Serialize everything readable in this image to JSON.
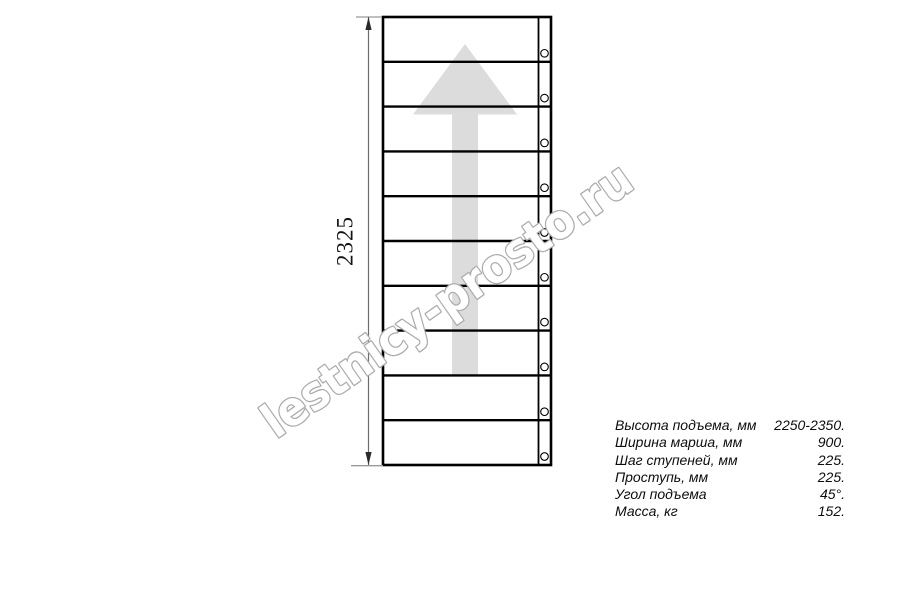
{
  "watermark": {
    "text": "lestnicy-prosto.ru",
    "fill": "#ffffff",
    "outline": "#acacac"
  },
  "drawing": {
    "dimension_label": "2325",
    "treads": 10,
    "arrow_direction": "up",
    "arrow_color": "#dcdcdc",
    "line_color": "#000000"
  },
  "specs": {
    "rows": [
      {
        "label": "Высота подъема, мм",
        "value": "2250-2350."
      },
      {
        "label": "Ширина марша, мм",
        "value": "900."
      },
      {
        "label": "Шаг ступеней, мм",
        "value": "225."
      },
      {
        "label": "Проступь, мм",
        "value": "225."
      },
      {
        "label": "Угол подъема",
        "value": "45°."
      },
      {
        "label": "Масса, кг",
        "value": "152."
      }
    ]
  }
}
